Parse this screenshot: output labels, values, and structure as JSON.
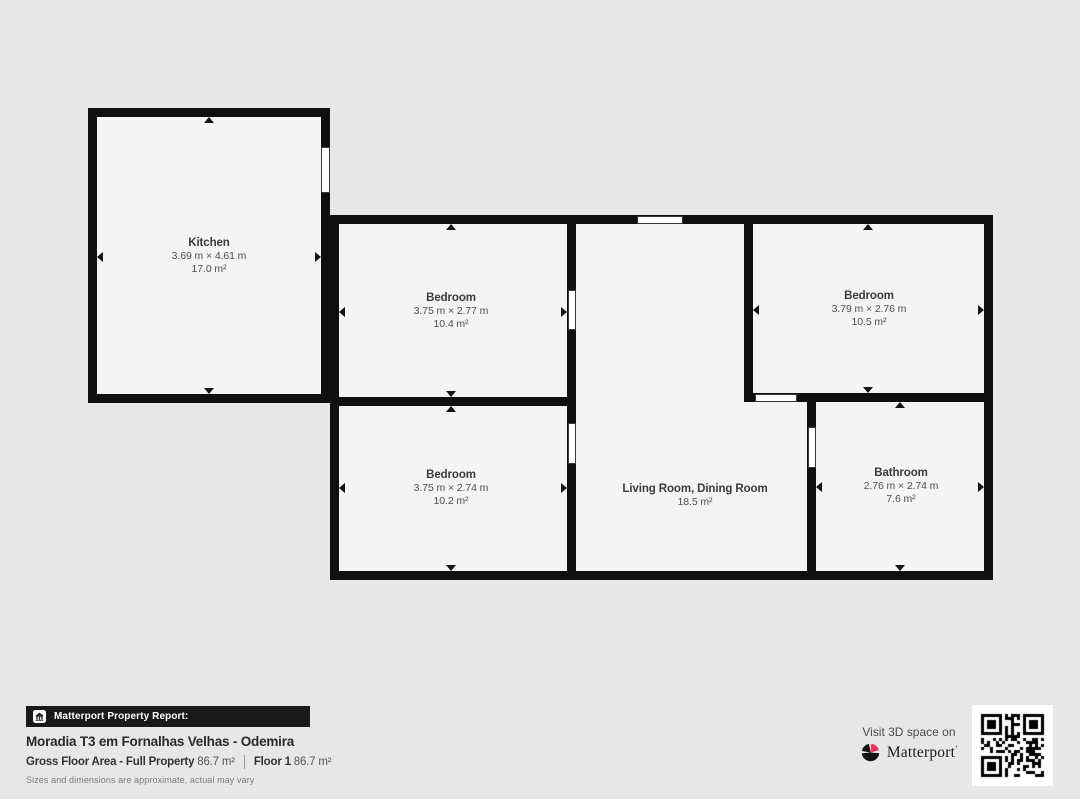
{
  "colors": {
    "background": "#e7e7e7",
    "wall": "#101010",
    "floor": "#f4f4f4",
    "accent": "#f1325e"
  },
  "rooms": {
    "kitchen": {
      "name": "Kitchen",
      "dimensions": "3.69 m × 4.61 m",
      "area": "17.0 m²"
    },
    "bedroom_top": {
      "name": "Bedroom",
      "dimensions": "3.75 m × 2.77 m",
      "area": "10.4 m²"
    },
    "bedroom_right": {
      "name": "Bedroom",
      "dimensions": "3.79 m × 2.76 m",
      "area": "10.5 m²"
    },
    "bedroom_bottom": {
      "name": "Bedroom",
      "dimensions": "3.75 m × 2.74 m",
      "area": "10.2 m²"
    },
    "living": {
      "name": "Living Room, Dining Room",
      "area": "18.5 m²"
    },
    "bathroom": {
      "name": "Bathroom",
      "dimensions": "2.76 m × 2.74 m",
      "area": "7.6 m²"
    }
  },
  "footer": {
    "badge_label": "Matterport Property Report:",
    "title": "Moradia T3 em Fornalhas Velhas - Odemira",
    "gross_label": "Gross Floor Area - Full Property",
    "gross_value": "86.7 m²",
    "floor_label": "Floor 1",
    "floor_value": "86.7 m²",
    "note": "Sizes and dimensions are approximate, actual may vary"
  },
  "cta": {
    "line": "Visit 3D space on",
    "brand": "Matterport",
    "mark": "’"
  }
}
